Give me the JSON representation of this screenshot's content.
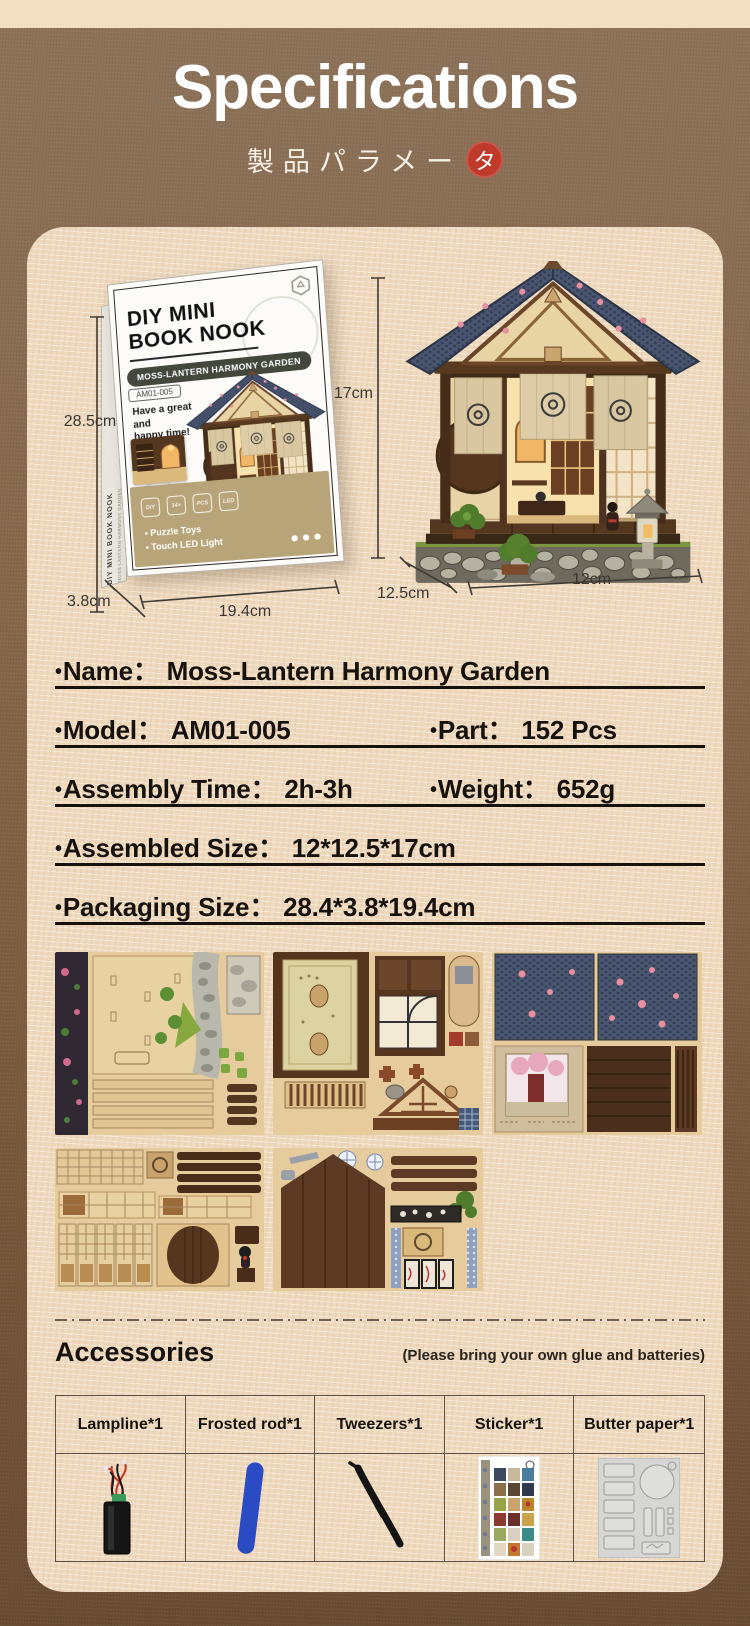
{
  "header": {
    "title": "Specifications",
    "subtitle_prefix": "製品パラメー",
    "subtitle_stamp": "タ"
  },
  "box": {
    "brand_line1": "DIY MINI",
    "brand_line2": "BOOK NOOK",
    "series": "MOSS-LANTERN HARMONY GARDEN",
    "model_tag": "AM01-005",
    "tagline_line1": "Have a great and",
    "tagline_line2": "happy time!",
    "spine_title": "DIY MINI BOOK NOOK",
    "spine_series": "MOSS-LANTERN HARMONY GARDEN",
    "icon_labels": [
      "DIY",
      "14+",
      "PCS",
      "LED"
    ],
    "features": [
      "Puzzle Toys",
      "Touch LED Light"
    ]
  },
  "dimensions": {
    "box_height": "28.5cm",
    "box_depth": "3.8cm",
    "box_width": "19.4cm",
    "house_height": "17cm",
    "house_depth": "12.5cm",
    "house_width": "12cm"
  },
  "specs": {
    "bullet": "•",
    "colon": "：",
    "rows": [
      {
        "c1": {
          "label": "Name",
          "value": "Moss-Lantern Harmony Garden"
        }
      },
      {
        "c1": {
          "label": "Model",
          "value": "AM01-005"
        },
        "c2": {
          "label": "Part",
          "value": "152 Pcs"
        }
      },
      {
        "c1": {
          "label": "Assembly Time",
          "value": "2h-3h"
        },
        "c2": {
          "label": "Weight",
          "value": "652g"
        }
      },
      {
        "c1": {
          "label": "Assembled Size",
          "value": "12*12.5*17cm"
        }
      },
      {
        "c1": {
          "label": "Packaging Size",
          "value": "28.4*3.8*19.4cm"
        }
      }
    ]
  },
  "accessories": {
    "heading": "Accessories",
    "note": "(Please bring your own glue and batteries)",
    "items": [
      {
        "name": "Lampline*1"
      },
      {
        "name": "Frosted rod*1"
      },
      {
        "name": "Tweezers*1"
      },
      {
        "name": "Sticker*1"
      },
      {
        "name": "Butter paper*1"
      }
    ]
  },
  "colors": {
    "stamp_red": "#bf3a2b",
    "background_brown": "#82654a",
    "panel_cream": "#eed9bd",
    "box_band_tan": "#b7a478",
    "frosted_rod_blue": "#2b4bc4"
  }
}
